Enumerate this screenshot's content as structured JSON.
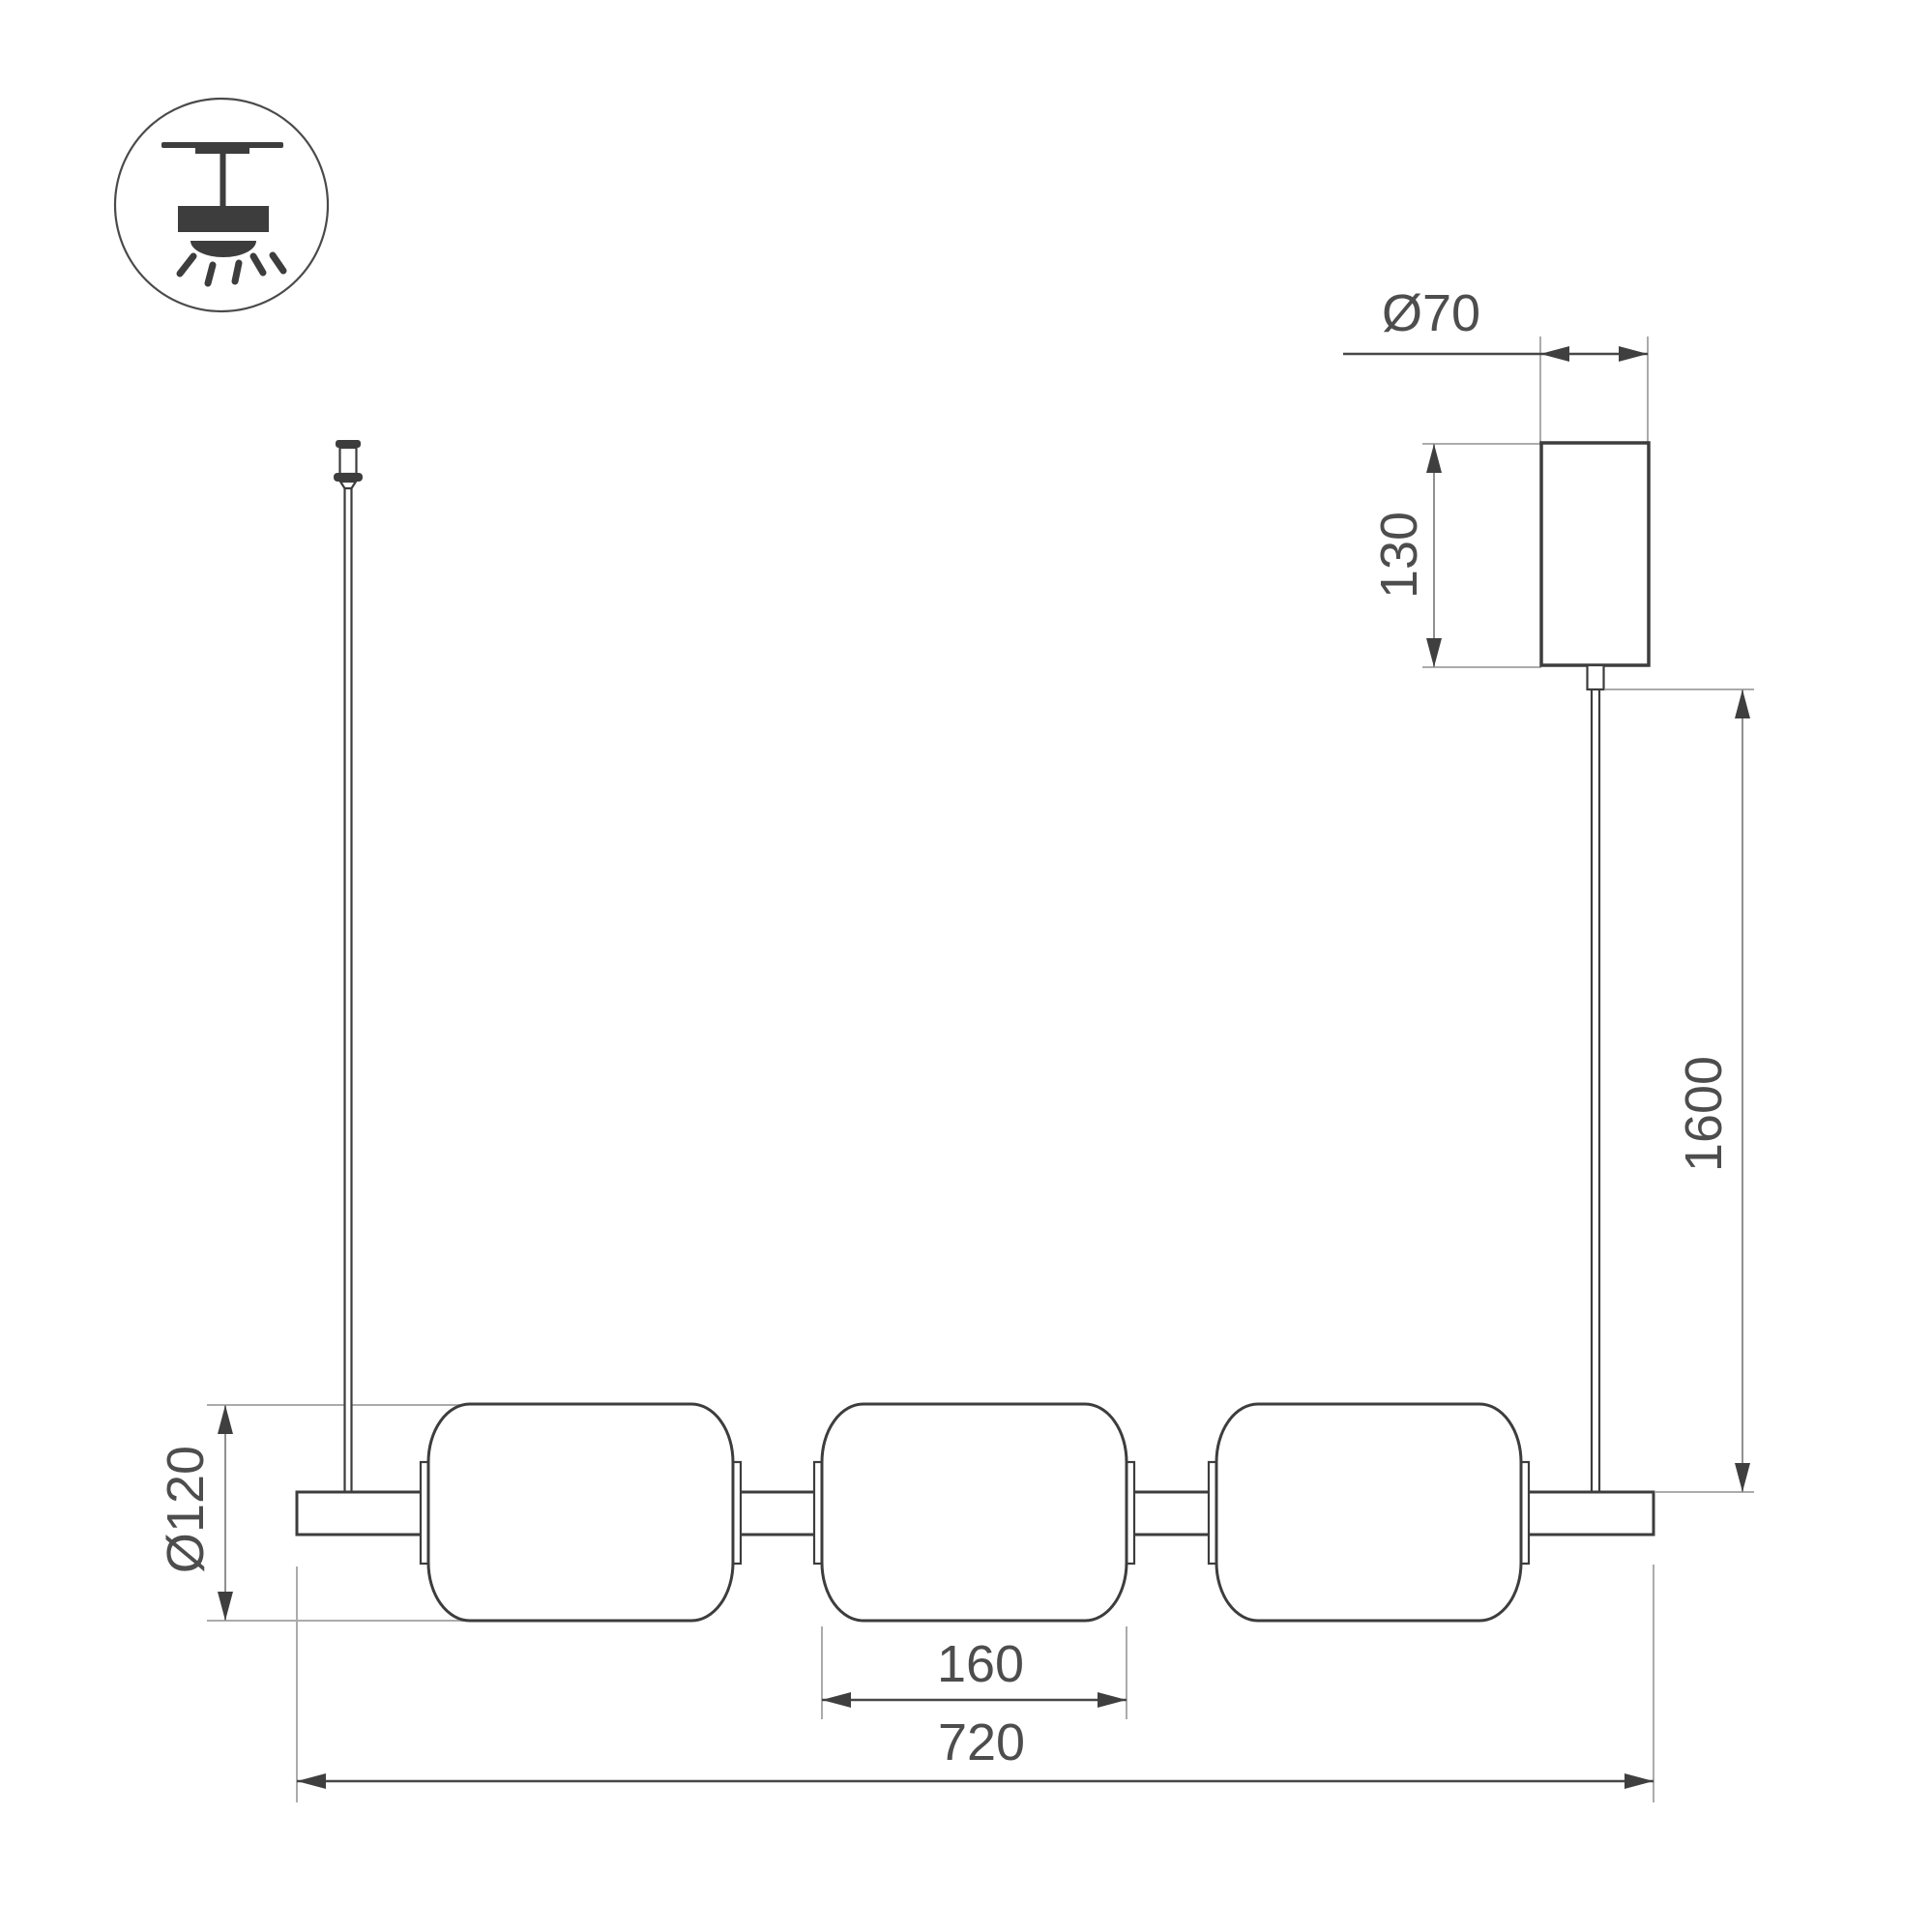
{
  "drawing": {
    "legend_icon": "ceiling-pendant-mount",
    "dimensions": {
      "canopy_diameter": "Ø70",
      "canopy_height": "130",
      "suspension_length": "1600",
      "shade_diameter": "Ø120",
      "shade_width": "160",
      "fixture_length": "720"
    },
    "colors": {
      "outline": "#3d3d3d",
      "dimension_line": "#474747",
      "dimension_line_light": "#909090",
      "extension_line": "#ababab",
      "label_text": "#4d4d4d",
      "background": "#ffffff"
    }
  }
}
